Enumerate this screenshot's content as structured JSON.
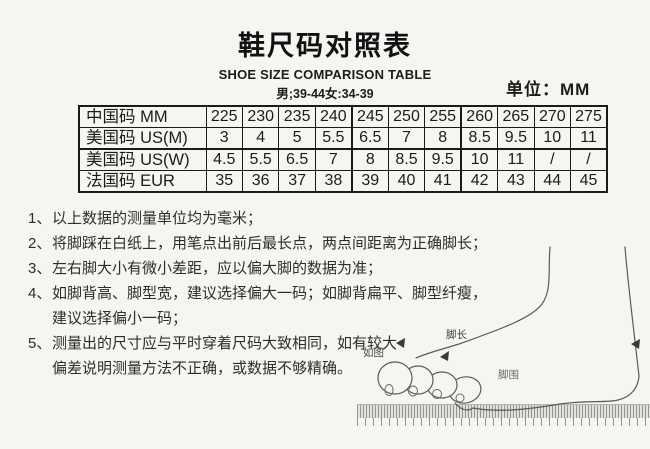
{
  "header": {
    "title": "鞋尺码对照表",
    "subtitle": "SHOE SIZE COMPARISON TABLE",
    "range": "男;39-44女:34-39",
    "unit_label": "单位：MM"
  },
  "size_table": {
    "rows": [
      {
        "label": "中国码 MM",
        "values": [
          "225",
          "230",
          "235",
          "240",
          "245",
          "250",
          "255",
          "260",
          "265",
          "270",
          "275"
        ]
      },
      {
        "label": "美国码 US(M)",
        "values": [
          "3",
          "4",
          "5",
          "5.5",
          "6.5",
          "7",
          "8",
          "8.5",
          "9.5",
          "10",
          "11"
        ]
      },
      {
        "label": "美国码 US(W)",
        "values": [
          "4.5",
          "5.5",
          "6.5",
          "7",
          "8",
          "8.5",
          "9.5",
          "10",
          "11",
          "/",
          "/"
        ]
      },
      {
        "label": "法国码 EUR",
        "values": [
          "35",
          "36",
          "37",
          "38",
          "39",
          "40",
          "41",
          "42",
          "43",
          "44",
          "45"
        ]
      }
    ]
  },
  "notes": {
    "items": [
      {
        "num": "1、",
        "lines": [
          "以上数据的测量单位均为毫米；"
        ]
      },
      {
        "num": "2、",
        "lines": [
          "将脚踩在白纸上，用笔点出前后最长点，两点间距离为正确脚长；"
        ]
      },
      {
        "num": "3、",
        "lines": [
          "左右脚大小有微小差距，应以偏大脚的数据为准；"
        ]
      },
      {
        "num": "4、",
        "lines": [
          "如脚背高、脚型宽，建议选择偏大一码；如脚背扁平、脚型纤瘦，",
          "建议选择偏小一码；"
        ]
      },
      {
        "num": "5、",
        "lines": [
          "测量出的尺寸应与平时穿着尺码大致相同，如有较大",
          "偏差说明测量方法不正确，或数据不够精确。"
        ]
      }
    ]
  },
  "figure": {
    "label_foot_length": "脚长",
    "label_foot_girth": "脚围",
    "label_as_shown": "如图"
  },
  "colors": {
    "background": "#f5f5f2",
    "table_border": "#1a1a1a",
    "sketch_line": "#5a5a5a"
  }
}
